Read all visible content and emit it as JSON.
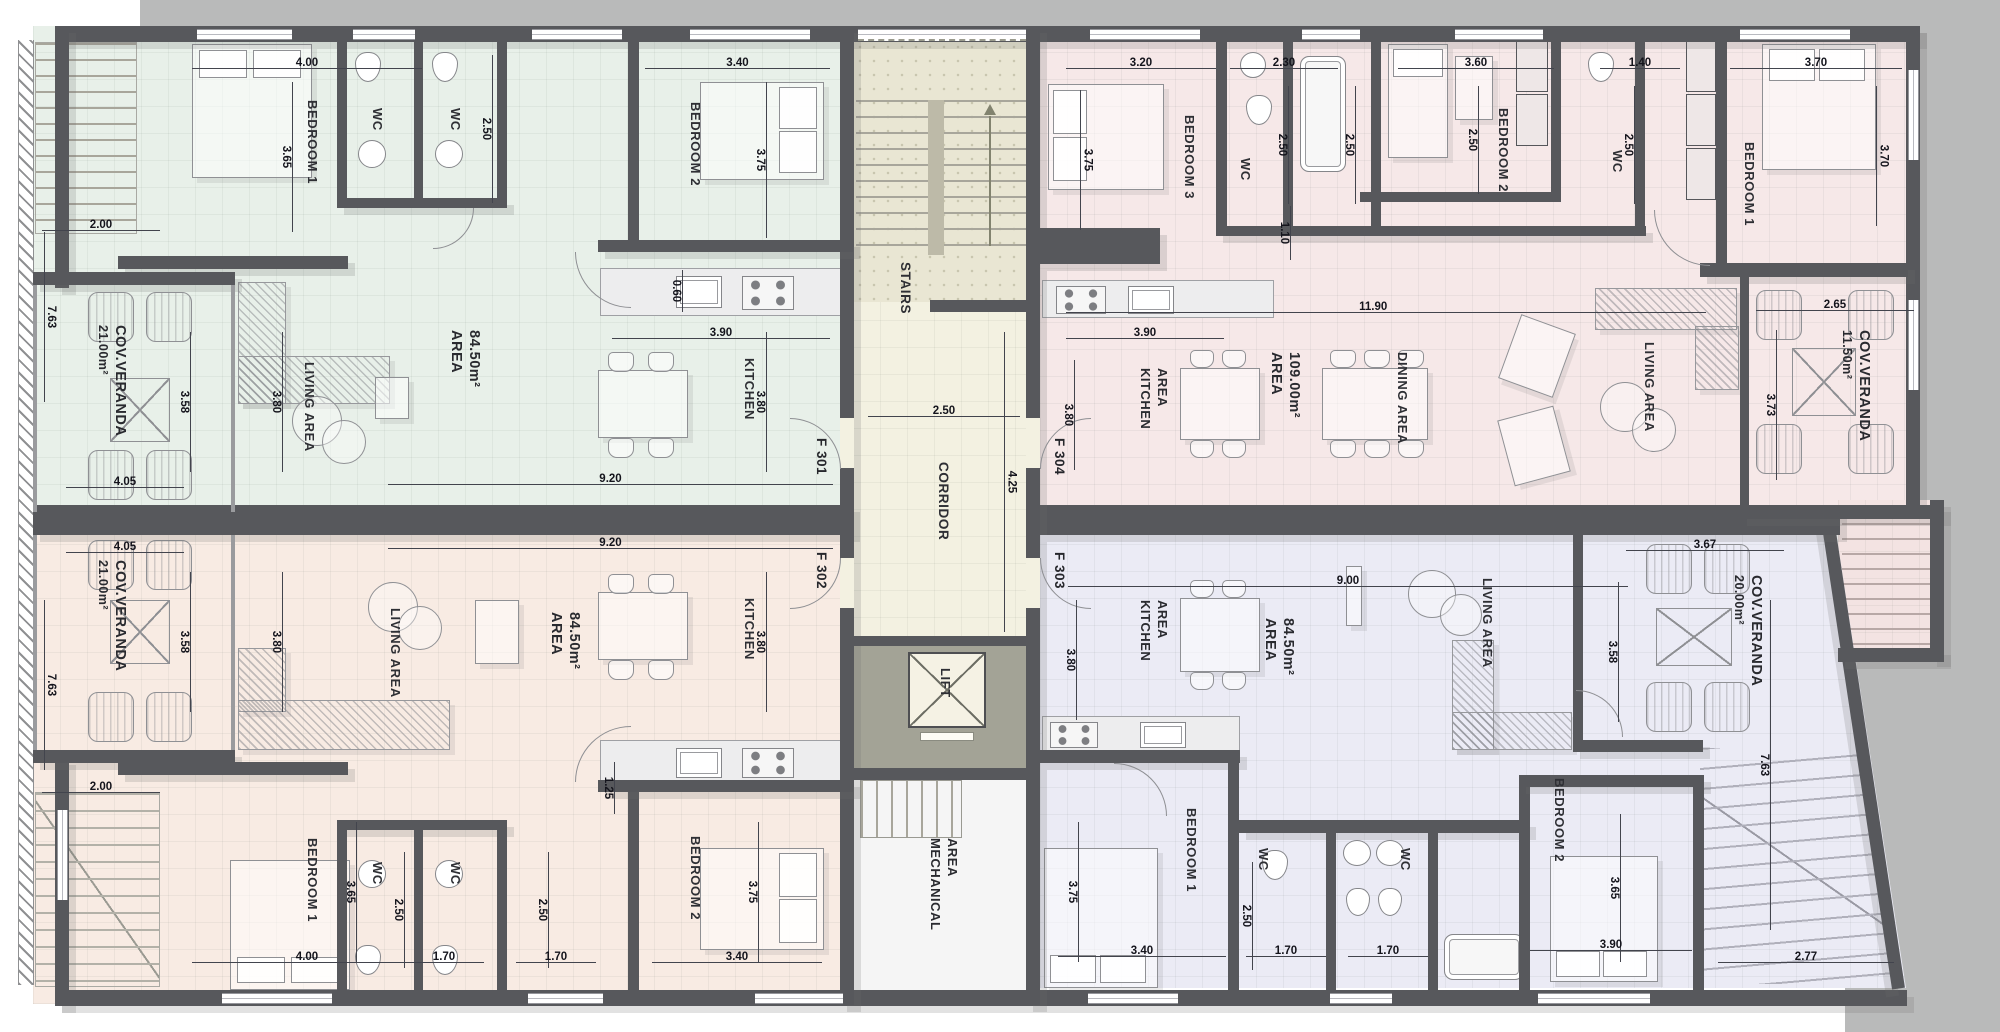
{
  "drawing": {
    "type": "apartment-building-floor-plan"
  },
  "core": {
    "stairs": "STAIRS",
    "corridor": "CORRIDOR",
    "lift": "LIFT",
    "mech1": "MECHANICAL",
    "mech2": "AREA",
    "dims": {
      "cw": "2.50",
      "ch": "4.25"
    }
  },
  "flats": {
    "f301": {
      "door": "F 301",
      "area1": "AREA",
      "area2": "84.50m²",
      "ver1": "21.00m²",
      "ver2": "COV.VERANDA",
      "rooms": {
        "bedroom1": "BEDROOM 1",
        "bedroom2": "BEDROOM 2",
        "wc1": "WC",
        "wc2": "WC",
        "kitchen": "KITCHEN",
        "living": "LIVING AREA"
      },
      "dims": {
        "b1w": "4.00",
        "b1h": "3.65",
        "wch": "2.50",
        "b2w": "3.40",
        "b2h": "3.75",
        "kw": "3.90",
        "kh": "3.80",
        "lh": "3.80",
        "lw": "9.20",
        "side": "2.00",
        "edge": "7.63",
        "vh": "3.58",
        "vw": "4.05",
        "sink": "0.60"
      }
    },
    "f302": {
      "door": "F 302",
      "area1": "AREA",
      "area2": "84.50m²",
      "ver1": "21.00m²",
      "ver2": "COV.VERANDA",
      "rooms": {
        "bedroom1": "BEDROOM 1",
        "bedroom2": "BEDROOM 2",
        "wc1": "WC",
        "wc2": "WC",
        "kitchen": "KITCHEN",
        "living": "LIVING AREA"
      },
      "dims": {
        "lw": "9.20",
        "vw": "4.05",
        "vh": "3.58",
        "lh": "3.80",
        "kh": "3.80",
        "hall": "1.25",
        "b1h": "3.65",
        "b1w": "4.00",
        "wc1h": "2.50",
        "wc2h": "2.50",
        "wc1w": "1.70",
        "wc2w": "1.70",
        "b2w": "3.40",
        "b2h": "3.75",
        "side": "2.00",
        "edge": "7.63"
      }
    },
    "f303": {
      "door": "F 303",
      "area1": "AREA",
      "area2": "84.50m²",
      "ver1": "20.00m²",
      "ver2": "COV.VERANDA",
      "rooms": {
        "kitchen1": "KITCHEN",
        "kitchen2": "AREA",
        "living": "LIVING AREA",
        "bedroom1": "BEDROOM 1",
        "bedroom2": "BEDROOM 2",
        "wc1": "WC",
        "wc2": "WC"
      },
      "dims": {
        "lw": "9.00",
        "kh": "3.80",
        "b1h": "3.75",
        "b1w": "3.40",
        "wch": "2.50",
        "wc1w": "1.70",
        "wc2w": "1.70",
        "b2h": "3.65",
        "b2w": "3.90",
        "vw": "3.67",
        "vh": "3.58",
        "edge": "7.63",
        "corner": "2.77"
      }
    },
    "f304": {
      "door": "F 304",
      "area1": "AREA",
      "area2": "109.00m²",
      "ver1": "11.50m²",
      "ver2": "COV.VERANDA",
      "rooms": {
        "bedroom3": "BEDROOM 3",
        "wc1": "WC",
        "bedroom2": "BEDROOM 2",
        "wc2": "WC",
        "bedroom1": "BEDROOM 1",
        "kitchen1": "KITCHEN",
        "kitchen2": "AREA",
        "dining": "DINING AREA",
        "living": "LIVING AREA"
      },
      "dims": {
        "b3w": "3.20",
        "b3h": "3.75",
        "wc1w": "2.30",
        "wc1h": "2.50",
        "bathh": "2.50",
        "b2w": "3.60",
        "b2h": "2.50",
        "wc2w": "1.40",
        "wc2h": "2.50",
        "b1w": "3.70",
        "b1h": "3.70",
        "hall": "1.10",
        "ow": "11.90",
        "kw": "3.90",
        "kh": "3.80",
        "vw": "2.65",
        "vh": "3.73"
      }
    }
  },
  "palette": {
    "f301": "#e8f0e9",
    "f302": "#f8ebe3",
    "f303": "#ebebf5",
    "f304": "#f6e8e8",
    "wall": "#57585c",
    "outside": "#b9baba",
    "stairs_bg": "#e9e6d3",
    "corridor_bg": "#f3f1e1",
    "lift_band": "#a3a396",
    "mech_bg": "#f5f5f5"
  }
}
